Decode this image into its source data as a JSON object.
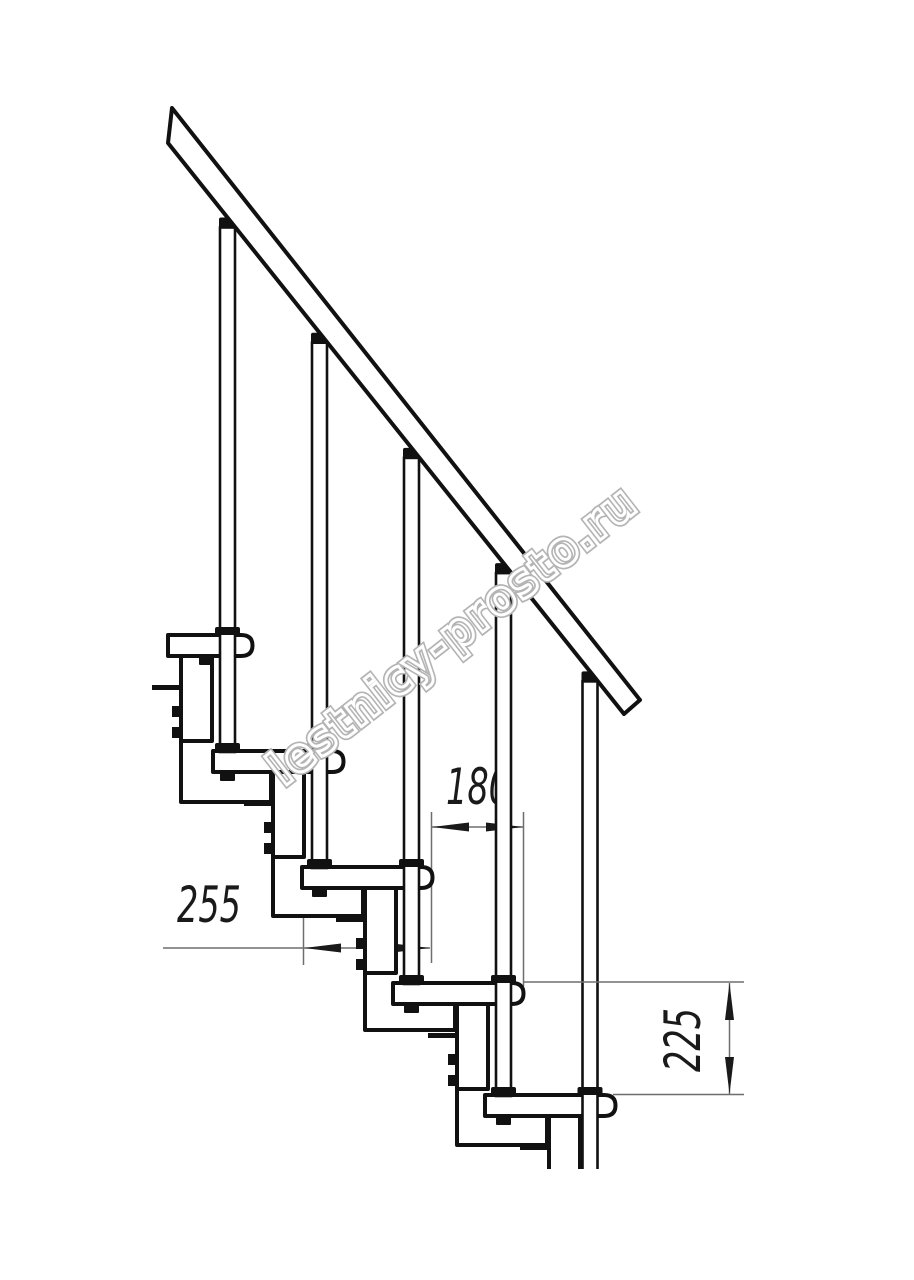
{
  "diagram": {
    "type": "technical-drawing",
    "subject": "modular-staircase-side-elevation",
    "watermark": "lestnicy-prosto.ru",
    "dimensions": [
      {
        "id": "run",
        "label": "180"
      },
      {
        "id": "tread-depth",
        "label": "255"
      },
      {
        "id": "rise",
        "label": "225"
      }
    ],
    "elements": {
      "treads": 5,
      "balusters": 5,
      "handrail": 1
    },
    "colors": {
      "background": "#ffffff",
      "line": "#111111",
      "thin_line": "#6e6e6e",
      "watermark_outline": "#b4b4b4"
    }
  }
}
